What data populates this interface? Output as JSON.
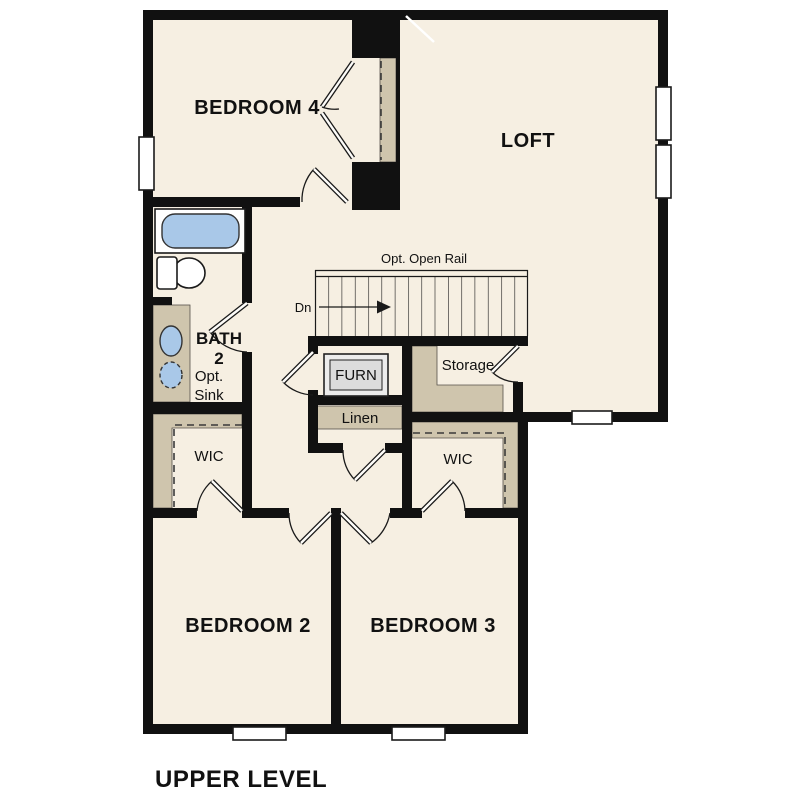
{
  "title": "UPPER LEVEL",
  "rooms": {
    "bedroom4": "BEDROOM 4",
    "loft": "LOFT",
    "bedroom2": "BEDROOM 2",
    "bedroom3": "BEDROOM 3",
    "bath_line1": "BATH",
    "bath_line2": "2",
    "opt_sink_line1": "Opt.",
    "opt_sink_line2": "Sink",
    "wic_left": "WIC",
    "wic_right": "WIC",
    "storage": "Storage",
    "linen": "Linen",
    "furnace": "FURN"
  },
  "stairs": {
    "direction": "Dn",
    "rail_note": "Opt. Open Rail"
  },
  "colors": {
    "wall": "#111111",
    "floor": "#f6efe2",
    "closet-fill": "#cfc5ad",
    "fixture-blue": "#a9c8e8",
    "furn-box": "#dcdcdc",
    "page-bg": "#ffffff",
    "text": "#111111"
  }
}
